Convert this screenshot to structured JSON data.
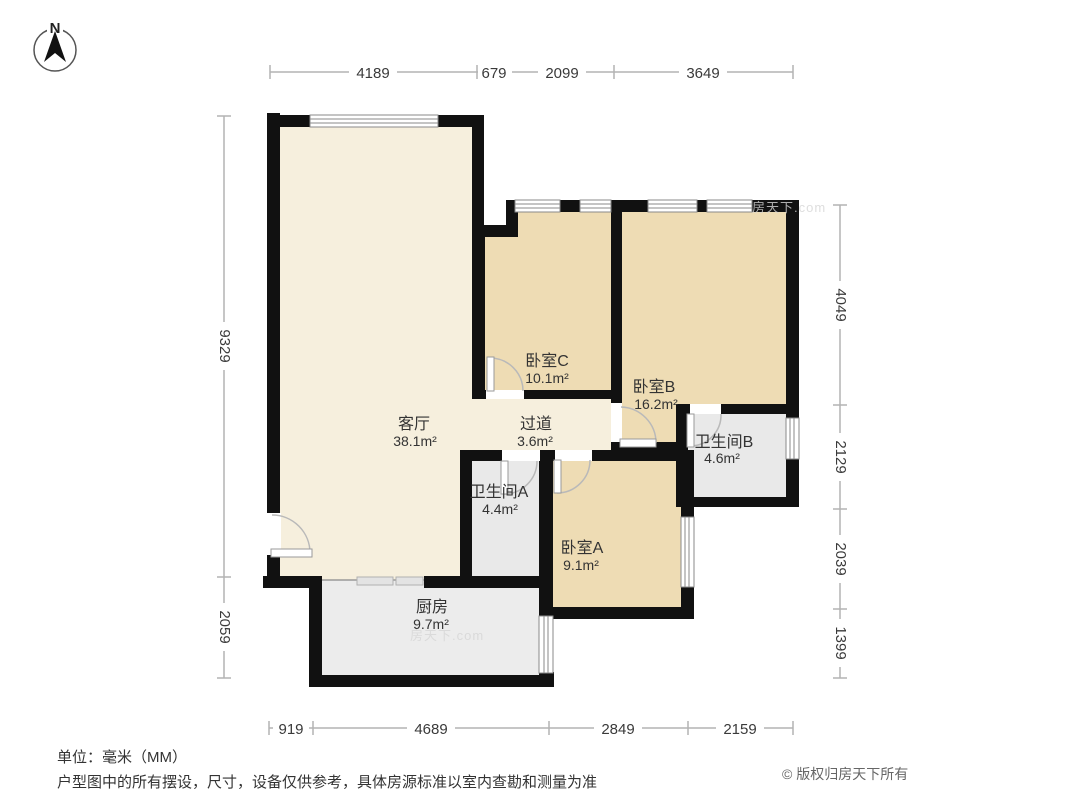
{
  "meta": {
    "compass_label": "N",
    "unit_note": "单位：毫米（MM）",
    "disclaimer": "户型图中的所有摆设，尺寸，设备仅供参考，具体房源标准以室内查勘和测量为准",
    "copyright": "© 版权归房天下所有",
    "watermark": "房天下.com"
  },
  "colors": {
    "wall": "#111111",
    "living_hall_fill": "#f6efdd",
    "bedroom_fill": "#eedcb4",
    "bathroom_fill": "#e9e9e9",
    "kitchen_fill": "#ececec",
    "dimension_line": "#b3b3b3",
    "text": "#333333"
  },
  "rooms": [
    {
      "id": "living-room",
      "name": "客厅",
      "area": "38.1m²"
    },
    {
      "id": "hallway",
      "name": "过道",
      "area": "3.6m²"
    },
    {
      "id": "bedroom-c",
      "name": "卧室C",
      "area": "10.1m²"
    },
    {
      "id": "bedroom-b",
      "name": "卧室B",
      "area": "16.2m²"
    },
    {
      "id": "bathroom-a",
      "name": "卫生间A",
      "area": "4.4m²"
    },
    {
      "id": "bathroom-b",
      "name": "卫生间B",
      "area": "4.6m²"
    },
    {
      "id": "bedroom-a",
      "name": "卧室A",
      "area": "9.1m²"
    },
    {
      "id": "kitchen",
      "name": "厨房",
      "area": "9.7m²"
    }
  ],
  "dimensions": {
    "unit": "mm",
    "top": [
      "4189",
      "679",
      "2099",
      "3649"
    ],
    "bottom": [
      "919",
      "4689",
      "2849",
      "2159"
    ],
    "left": [
      "9329",
      "2059"
    ],
    "right": [
      "4049",
      "2129",
      "2039",
      "1399"
    ]
  }
}
